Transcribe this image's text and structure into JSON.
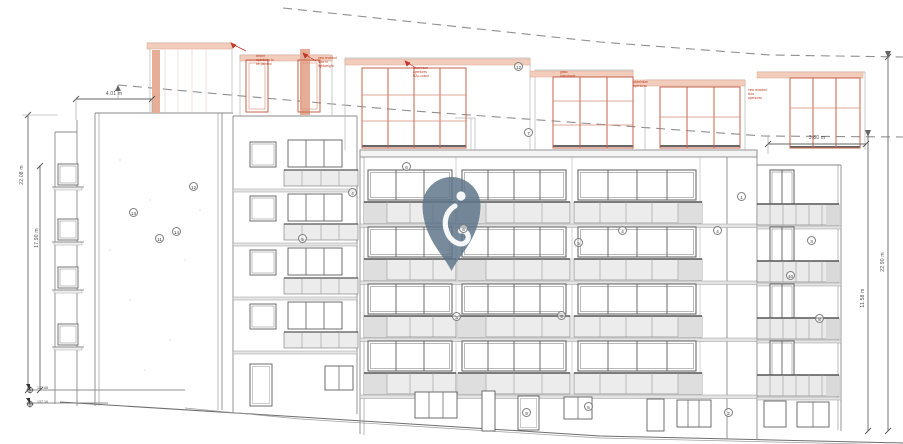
{
  "drawing": {
    "type": "front elevation - apartment block with proposed receded floor",
    "dim_top_left": "4.01 m",
    "dim_top_right": "3.80 m",
    "dim_left_outer": "22.08 m",
    "dim_left_inner": "17.90 m",
    "dim_right_outer": "22.90 m",
    "dim_right_inner": "11.58 m",
    "level_upper": "137.68",
    "level_lower": "137.16"
  },
  "watermark": {
    "icon": "map-pin-logo",
    "color": "#5d7589"
  },
  "tags": [
    {
      "n": "1"
    },
    {
      "n": "2"
    },
    {
      "n": "3"
    },
    {
      "n": "3"
    },
    {
      "n": "4"
    },
    {
      "n": "4"
    },
    {
      "n": "4"
    },
    {
      "n": "5"
    },
    {
      "n": "5"
    },
    {
      "n": "5"
    },
    {
      "n": "6"
    },
    {
      "n": "6"
    },
    {
      "n": "7"
    },
    {
      "n": "8"
    },
    {
      "n": "9"
    },
    {
      "n": "9"
    },
    {
      "n": "10"
    },
    {
      "n": "11"
    },
    {
      "n": "12"
    },
    {
      "n": "12"
    },
    {
      "n": "13"
    },
    {
      "n": "14"
    }
  ],
  "annotations": {
    "a1": "timber\napertures to\nbe painted",
    "a2": "new receded\nfloor in\nlightweight",
    "a3": "aluminium\napertures\nRAL colour",
    "a4": "glass\nbalustrade",
    "a5": "aluminium\napertures",
    "a6": "new receded\nfloor\napertures"
  }
}
